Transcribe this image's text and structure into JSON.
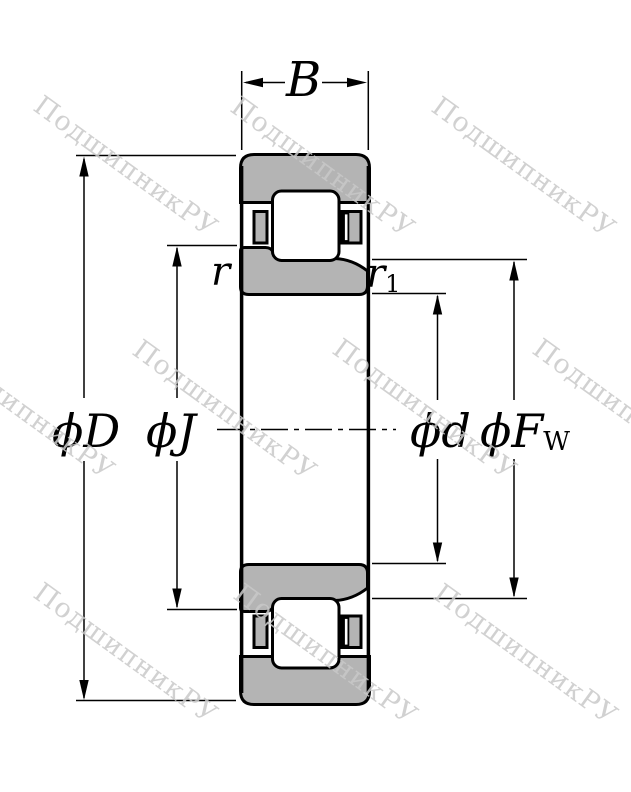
{
  "watermark": {
    "text": "ПодшипникРУ",
    "positions": [
      {
        "x": 46,
        "y": 90
      },
      {
        "x": 243,
        "y": 91
      },
      {
        "x": 444,
        "y": 91
      },
      {
        "x": -57,
        "y": 333
      },
      {
        "x": 145,
        "y": 334
      },
      {
        "x": 345,
        "y": 333
      },
      {
        "x": 545,
        "y": 333
      },
      {
        "x": 46,
        "y": 577
      },
      {
        "x": 246,
        "y": 578
      },
      {
        "x": 446,
        "y": 578
      }
    ]
  },
  "colors": {
    "background": "#ffffff",
    "outline": "#000000",
    "ring_fill": "#b4b4b4",
    "watermark": "#c9c9c9"
  },
  "dimension_labels": {
    "width": "B",
    "outer_diameter": "ϕD",
    "flange_diameter": "ϕJ",
    "bore_diameter": "ϕd",
    "raceway_diameter_main": "ϕF",
    "raceway_diameter_sub": "W",
    "outer_chamfer": "r",
    "inner_chamfer_main": "r",
    "inner_chamfer_sub": "1"
  }
}
